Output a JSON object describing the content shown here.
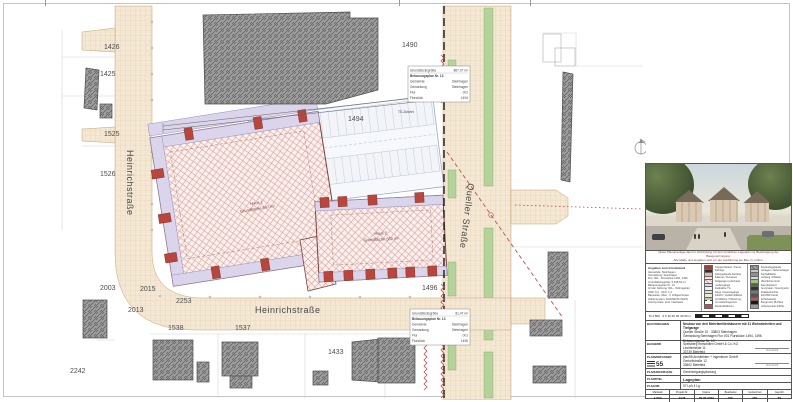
{
  "plan": {
    "street_names": {
      "heinrich_vertical": "Heinrichstraße",
      "heinrich_horizontal": "Heinrichstraße",
      "queller": "Queller Straße"
    },
    "parcels": {
      "p1426": "1426",
      "p1425": "1425",
      "p1525": "1525",
      "p1526": "1526",
      "p2003": "2003",
      "p2015": "2015",
      "p2013": "2013",
      "p2253": "2253",
      "p2242": "2242",
      "p1538": "1538",
      "p1537": "1537",
      "p1433": "1433",
      "p1490": "1490",
      "p1494": "1494",
      "p1496": "1496"
    },
    "haus1": {
      "name": "Haus 1",
      "area": "Grundfläche 847 m²"
    },
    "haus2": {
      "name": "Haus 2",
      "area": "Grundfläche 562 m²"
    },
    "tg_label": "TG-Zufahrt",
    "box1": {
      "l1": "Grundstücksgröße",
      "v1": "867,07 m²",
      "l2": "Bebauungsplan Nr. 13",
      "l3": "Gemeinde",
      "v3": "Steinhagen",
      "l4": "Gemarkung",
      "v4": "Steinhagen",
      "l5": "Flur",
      "v5": "001",
      "l6": "Flurstück",
      "v6": "1494"
    },
    "box2": {
      "l1": "Grundstücksgröße",
      "v1": "81,47 m²",
      "l2": "Bebauungsplan Nr. 13",
      "l3": "Gemeinde",
      "v3": "Steinhagen",
      "l4": "Gemarkung",
      "v4": "Steinhagen",
      "l5": "Flur",
      "v5": "001",
      "l6": "Flurstück",
      "v6": "1496"
    }
  },
  "titleblock": {
    "note_line1": "Diese Planunterlage dient in Verbindung mit dem Amtlichen Lageplan zur Beantragung der Baugenehmigung.",
    "note_line2": "Alle Maße und Angaben sind vor der Ausführung am Bau zu prüfen.",
    "legend": {
      "col1_header": "Angaben zum Grundstück",
      "col1_lines": [
        "Gemeinde: Steinhagen",
        "Gemarkung: Steinhagen",
        "Flur: 001 · Flurstücke 1494, 1496",
        "Grundstücksgröße: 6.948,54 m²",
        "Bebauungsplan Nr. 13",
        "Art der Nutzung: WA – Wohngebiet",
        "GRZ: 0,4 · GFZ: 1,2",
        "Bauweise: offen · II Vollgeschosse",
        "Höhensystem: DHHN2016 (NHN)",
        "Grenzpunkte: amtl. Nachweis"
      ],
      "col2": [
        {
          "style": "background:#b03a2e",
          "label": "Treppenhäuser / Kerne"
        },
        {
          "style": "background:#2f2f2f",
          "label": "Aufzüge"
        },
        {
          "style": "background:#eab4aa",
          "label": "Wohngebäude Neubau"
        },
        {
          "style": "background:#f7e4e0",
          "label": "Balkone / Terrassen"
        },
        {
          "style": "background:repeating-linear-gradient(45deg,#faf0ee 0 2px,#d79a92 2px 3px)",
          "label": "Tiefgarage (unterbaut)"
        },
        {
          "style": "background:#dbd5ec",
          "label": "Laubengänge"
        },
        {
          "style": "background:#eef0f5",
          "label": "Stellplätze TG"
        },
        {
          "style": "background:#e0e0e0",
          "label": "Wege / Hauszugänge"
        },
        {
          "style": "background:#f4e7d3",
          "label": "Zufahrt / Verkehrsfläche"
        },
        {
          "style": "background:#b5d29a",
          "label": "Grünfläche / Pflanzung"
        },
        {
          "style": "background:#fff;border:.5px dashed #444",
          "label": "Grundstücksgrenze"
        },
        {
          "style": "background:#c0504d",
          "label": "Abstandsflächen"
        }
      ],
      "col3": [
        {
          "style": "background:repeating-linear-gradient(45deg,#a2a2a2 0 2px,#6a6a6a 2px 3px)",
          "label": "Bestandsgebäude"
        },
        {
          "style": "background:#c6c6c6",
          "label": "Garagen / Nebenanlagen"
        },
        {
          "style": "background:#8f8f8f",
          "label": "Asphaltfläche"
        },
        {
          "style": "background:#d8d8d8",
          "label": "Gehweg / Pflaster"
        },
        {
          "style": "background:#9dbf83",
          "label": "öffentliches Grün"
        },
        {
          "style": "background:#4f6f3f",
          "label": "Baumbestand"
        },
        {
          "style": "background:#333333",
          "label": "Grenzstein / Grenzpunkt"
        },
        {
          "style": "background:#777777",
          "label": "Straßenleuchte"
        },
        {
          "style": "background:#555555",
          "label": "SW-/RW-Kanal"
        },
        {
          "style": "background:#c0504d",
          "label": "Sichtdreiecke"
        },
        {
          "style": "background:#1a1a1a",
          "label": "Baugrenze (B-Plan)"
        },
        {
          "style": "background:#9a9a9a",
          "label": "Höhenpunkte (NHN)"
        }
      ],
      "scale_text": "M 1:500 · 0  5  10  20  30  40  50 m"
    },
    "rows": {
      "bauvorhaben_label": "Bauvorhaben",
      "bv1": "Neubau von drei Mehrfamilienhäusern mit 31 Wohneinheiten und Tiefgarage",
      "bv2": "Queller Straße 10 · 33803 Steinhagen",
      "bv3": "Gemarkung Steinhagen    Flur 001    Flurstücke 1494, 1496",
      "bv4": "Bebauungsplan Nr. 13",
      "bauherr_label": "Bauherr",
      "bh1": "Spelsberg Immobilien GmbH & Co. KG",
      "bh2": "Lechterheide 11",
      "bh3": "33739 Bielefeld",
      "bh_sig": "Unterschrift",
      "planverfasser_label": "Planverfasser",
      "logo_text": "55",
      "pv1": "plan55 Architekten + Ingenieure GmbH",
      "pv2": "Gerichtstraße 12",
      "pv3": "33602 Bielefeld",
      "pv_sig": "Unterschrift",
      "phase_label": "Planungsphase",
      "phase_value": "Genehmigungsplanung",
      "titel_label": "Plantitel",
      "titel_value": "Lageplan",
      "nr_label": "Plan Nr.",
      "nr_value": "07 Lph 4 Lg"
    },
    "footer": {
      "c1l": "Maßstab",
      "c1v": "1:500",
      "c2l": "Projekt-Nr.",
      "c2v": "2148",
      "c3l": "Datum",
      "c3v": "05.05.2023",
      "c4l": "Bearbeiter",
      "c4v": "MG",
      "c5l": "Gezeichnet",
      "c5v": "MG",
      "c6l": "Geprüft",
      "c6v": "TS"
    }
  }
}
